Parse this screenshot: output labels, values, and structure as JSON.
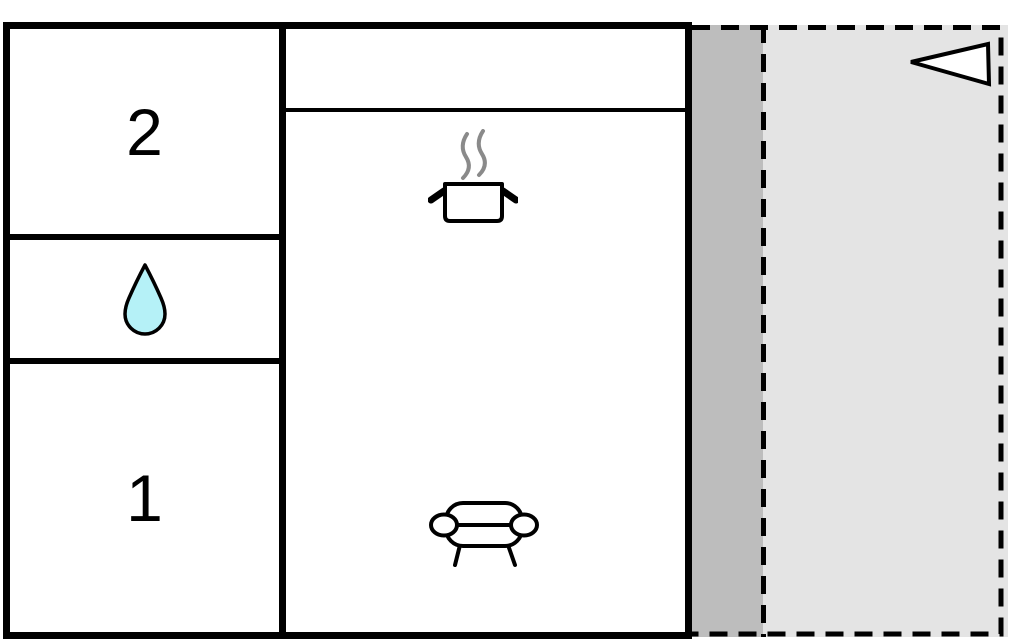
{
  "floor_plan": {
    "rooms": {
      "room_2_label": "2",
      "room_1_label": "1"
    },
    "icons": {
      "bathroom": "water-drop-icon",
      "kitchen": "cooking-pot-with-steam-icon",
      "living_area": "sofa-icon",
      "terrace_marker": "left-pointing-triangle-icon"
    },
    "colors": {
      "walls": "#000000",
      "room_fill": "#ffffff",
      "terrace_fill": "#e4e4e4",
      "terrace_strip_fill": "#bdbdbd",
      "water_drop_fill": "#b5f1f7",
      "steam": "#8a8a8a"
    }
  }
}
